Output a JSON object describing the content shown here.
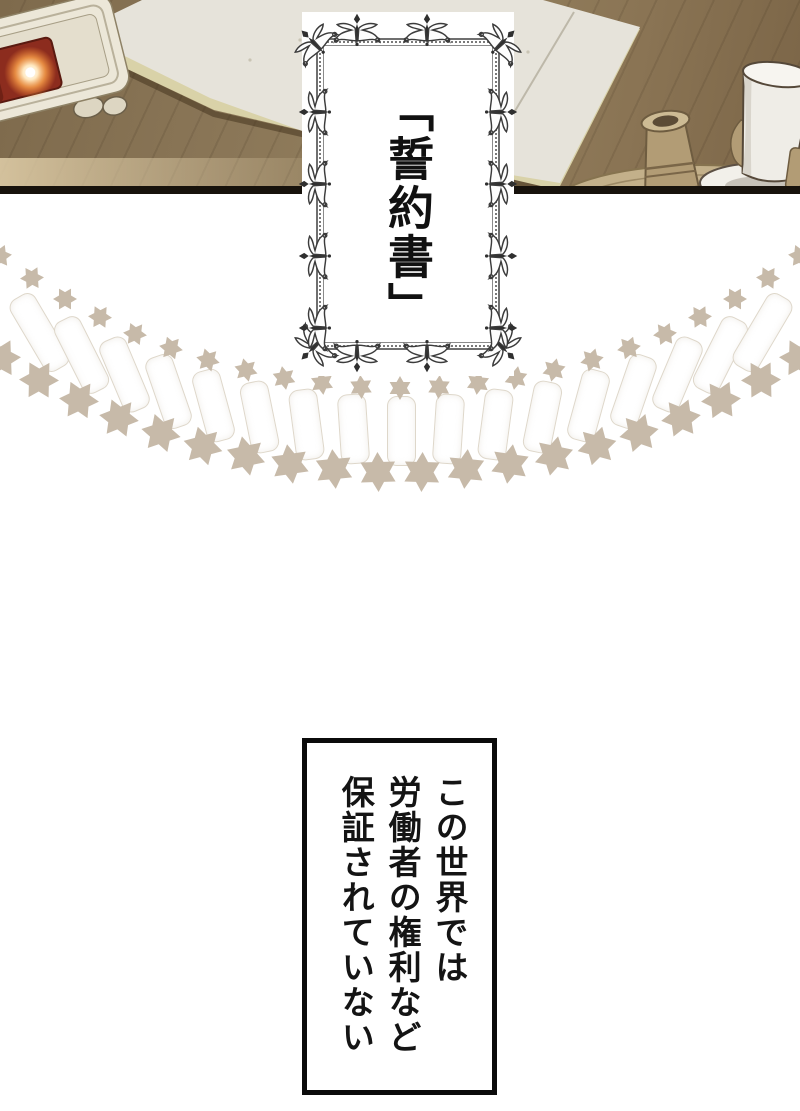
{
  "frame": {
    "title": "「誓約書」"
  },
  "caption": {
    "lines": [
      "この世界では",
      "労働者の権利など",
      "保証されていない"
    ]
  },
  "colors": {
    "desk": "#8a7557",
    "desk_dark": "#6f5c41",
    "desk_light": "#b7a37c",
    "paper": "#e6e3da",
    "paper_under": "#d9d2a8",
    "divider": "#17120c",
    "star": "#c7baa9",
    "ray_edge": "#ded7ca",
    "seal_box": "#ece7d8",
    "seal_red": "#8c2c1e",
    "glow": "#ffa64d",
    "tray": "#c3b08a",
    "pot": "#b29c75",
    "cup": "#efede7",
    "ink": "#4f4337",
    "frame_border": "#6f6f6f",
    "text": "#141414"
  },
  "icons": {
    "star": "six-pointed-star-icon",
    "ornament": "floral-ornament-icon",
    "glow": "glow-orb-icon"
  }
}
